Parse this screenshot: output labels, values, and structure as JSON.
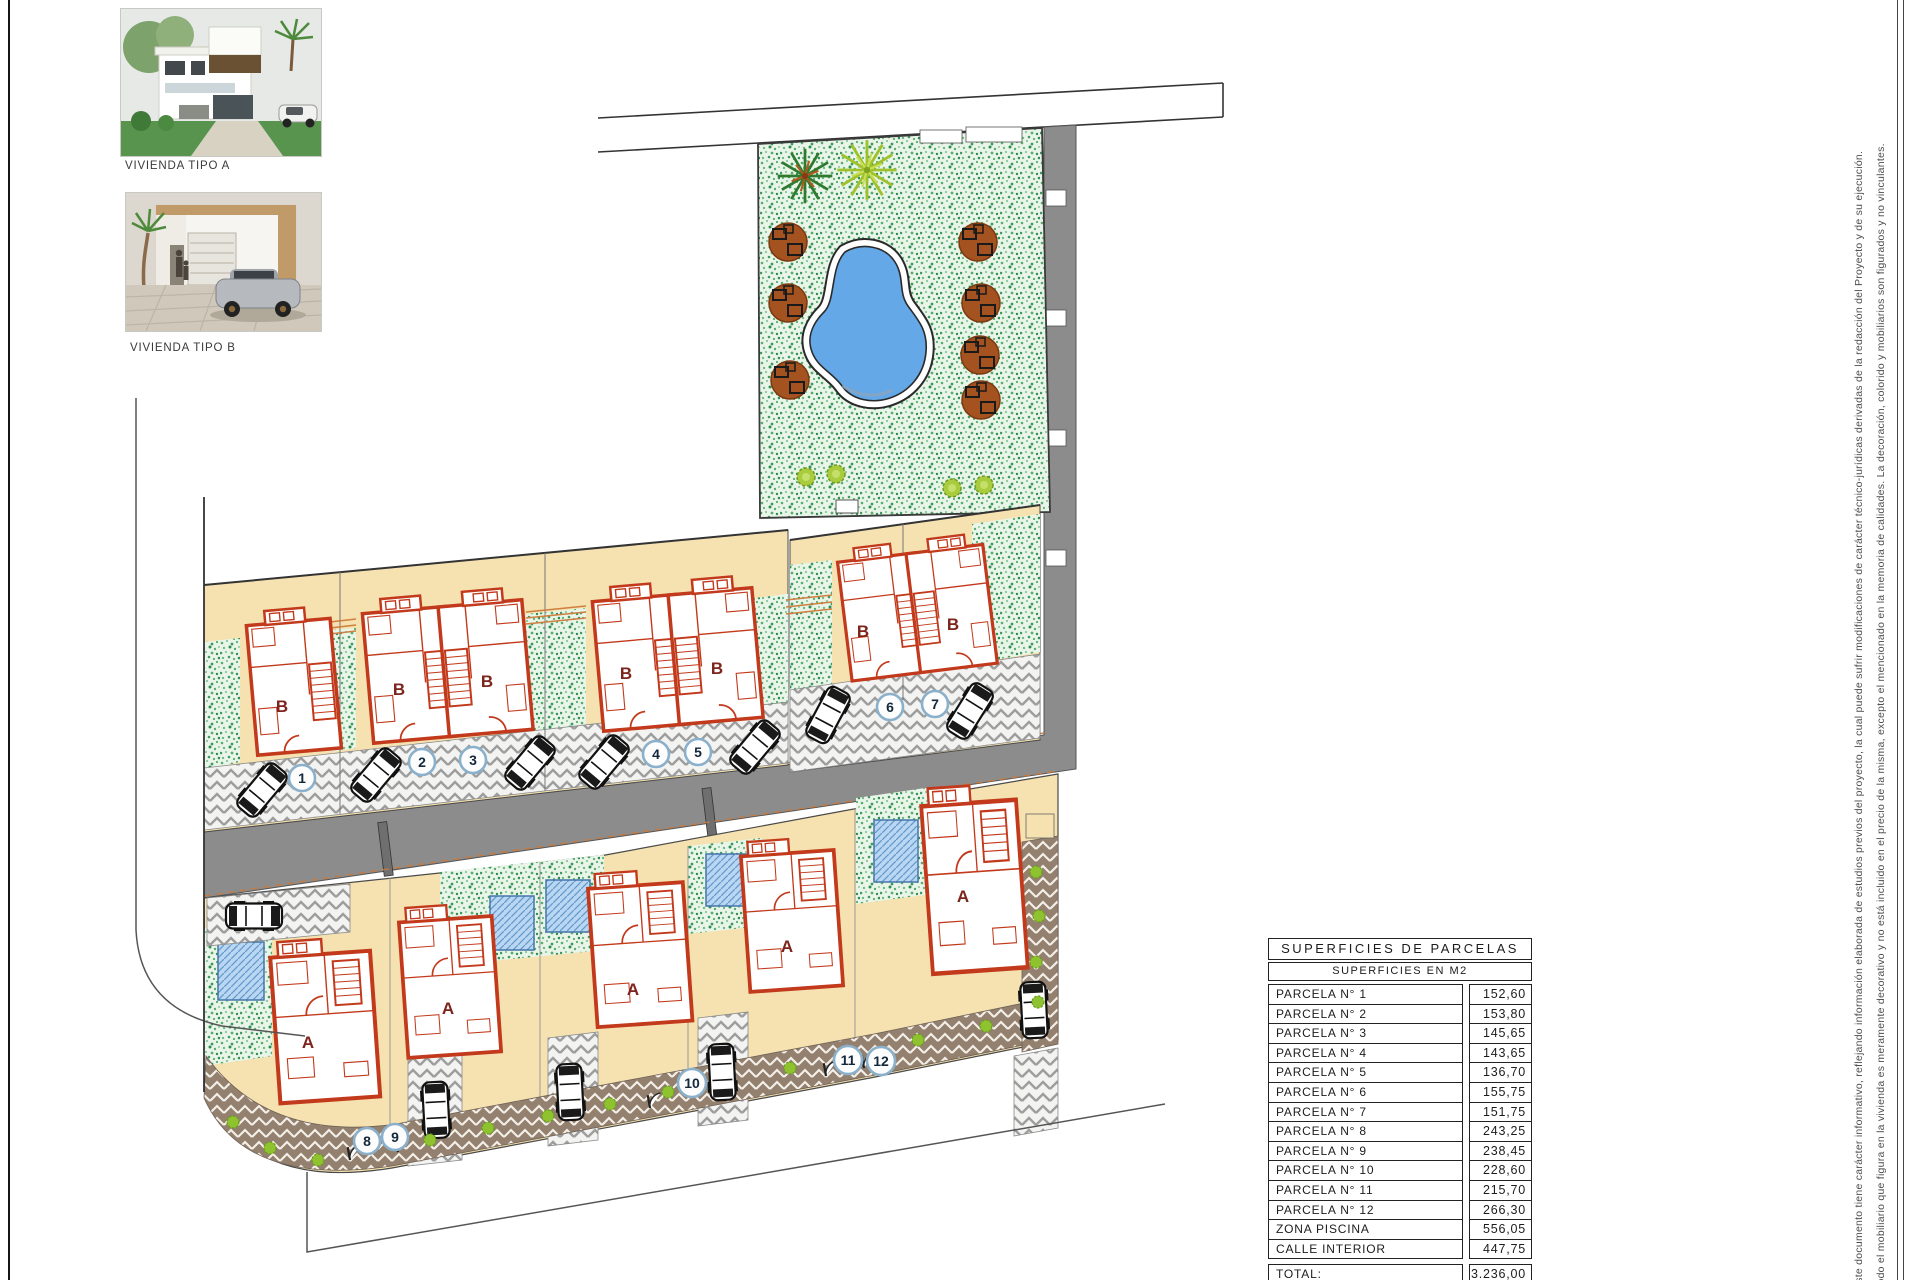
{
  "legend": {
    "tipo_a_caption": "VIVIENDA TIPO A",
    "tipo_b_caption": "VIVIENDA TIPO B"
  },
  "plan": {
    "house_type_a": "A",
    "house_type_b": "B",
    "plot_numbers": [
      "1",
      "2",
      "3",
      "4",
      "5",
      "6",
      "7",
      "8",
      "9",
      "10",
      "11",
      "12"
    ]
  },
  "table": {
    "title": "SUPERFICIES DE PARCELAS",
    "subtitle": "SUPERFICIES EN M2",
    "rows": [
      {
        "label": "PARCELA N° 1",
        "value": "152,60"
      },
      {
        "label": "PARCELA N° 2",
        "value": "153,80"
      },
      {
        "label": "PARCELA N° 3",
        "value": "145,65"
      },
      {
        "label": "PARCELA N° 4",
        "value": "143,65"
      },
      {
        "label": "PARCELA N° 5",
        "value": "136,70"
      },
      {
        "label": "PARCELA N° 6",
        "value": "155,75"
      },
      {
        "label": "PARCELA N° 7",
        "value": "151,75"
      },
      {
        "label": "PARCELA N° 8",
        "value": "243,25"
      },
      {
        "label": "PARCELA N° 9",
        "value": "238,45"
      },
      {
        "label": "PARCELA N° 10",
        "value": "228,60"
      },
      {
        "label": "PARCELA N° 11",
        "value": "215,70"
      },
      {
        "label": "PARCELA N° 12",
        "value": "266,30"
      },
      {
        "label": "ZONA PISCINA",
        "value": "556,05"
      },
      {
        "label": "CALLE INTERIOR",
        "value": "447,75"
      }
    ],
    "total": {
      "label": "TOTAL:",
      "value": "3.236,00"
    }
  },
  "disclaimers": {
    "line_documento": "Este documento tiene carácter informativo, reflejando información elaborada de estudios previos del proyecto, la cual puede sufrir modificaciones de carácter técnico-jurídicas derivadas de la redacción del Proyecto y de su ejecución.",
    "line_mobiliario": "Todo el mobiliario que figura en la vivienda es meramente decorativo y no está incluido en el precio de la misma, excepto el mencionado en la memoria de calidades. La decoración, colorido y mobiliarios son figurados y no vinculantes."
  },
  "colors": {
    "wall_red": "#c2391b",
    "grass_green": "#57ad6b",
    "pool_blue": "#64a8e8",
    "road_gray": "#8c8c8c",
    "parcel_beige": "#f5e2b0",
    "sidewalk_brown": "#93806e",
    "plot_circle_blue": "#8ab0cc"
  }
}
